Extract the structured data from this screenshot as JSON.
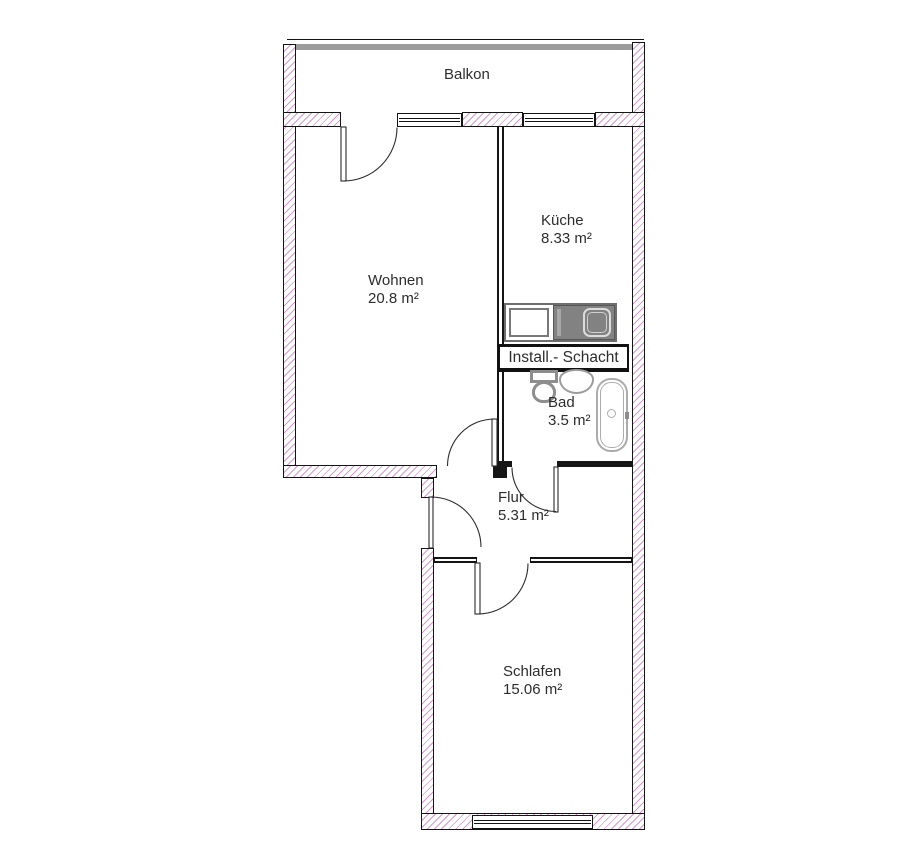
{
  "rooms": {
    "balkon": {
      "label": "Balkon"
    },
    "wohnen": {
      "label": "Wohnen",
      "area": "20.8 m²"
    },
    "kueche": {
      "label": "Küche",
      "area": "8.33 m²"
    },
    "schacht": {
      "label": "Install.- Schacht"
    },
    "bad": {
      "label": "Bad",
      "area": "3.5 m²"
    },
    "flur": {
      "label": "Flur",
      "area": "5.31 m²"
    },
    "schlafen": {
      "label": "Schlafen",
      "area": "15.06 m²"
    }
  },
  "fixtures": {
    "kitchen_counter": "kitchen counter with stove and sink",
    "toilet": "toilet",
    "washbasin": "washbasin",
    "bathtub": "bathtub"
  },
  "colors": {
    "wall_hatch": "#c988c1",
    "wall_outline": "#141414",
    "balcony_rail": "#9c9c9c",
    "fixture_gray": "#828282",
    "text": "#2d2d2d"
  }
}
